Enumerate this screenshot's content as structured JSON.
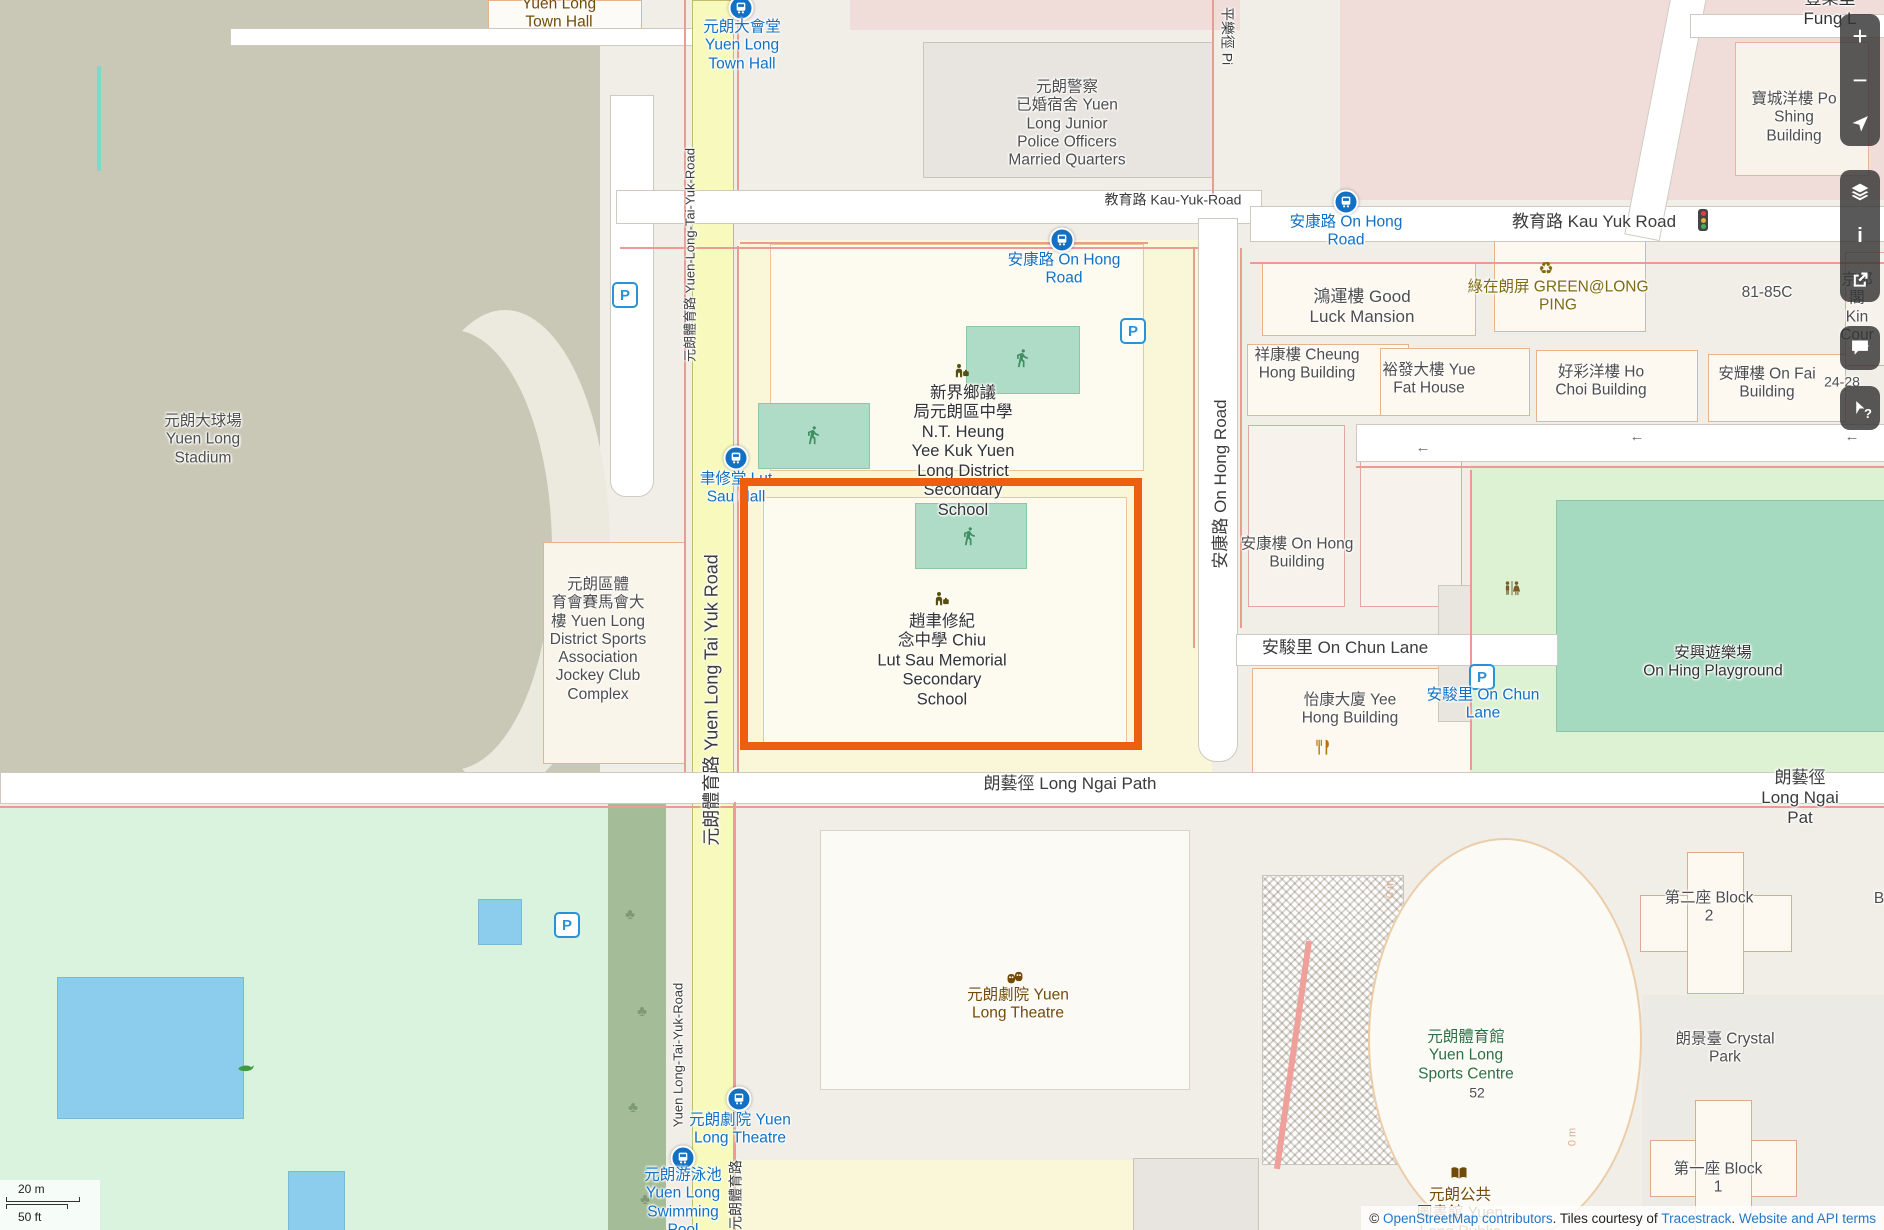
{
  "map_type": "openstreetmap-yuen-long",
  "colors": {
    "highlight": "#ed5f0e",
    "pitch": "#aedcc6",
    "water": "#8cccec",
    "road_yellow": "#f7fabc",
    "park_green": "#ddf2d3",
    "stadium_olive": "#c9c8b6",
    "transit_blue": "#1271c4",
    "amenity_brown": "#734a08"
  },
  "icons": {
    "tree": "♣",
    "recycle": "♻"
  },
  "roads": {
    "kau_yuk_left": "教育路 Kau-Yuk-Road",
    "kau_yuk_right": "教育路 Kau Yuk Road",
    "tai_yuk_small_top": "元朗體育路 Yuen-Long-Tai-Yuk-Road",
    "tai_yuk_main": "元朗體育路 Yuen Long Tai Yuk Road",
    "tai_yuk_small_bottom": "Yuen Long-Tai-Yuk-Road",
    "tai_yuk_cjk_bottom": "元朗體育路",
    "on_hong": "安康路 On Hong Road",
    "on_chun": "安駿里 On Chun Lane",
    "long_ngai_left": "朗藝徑 Long Ngai Path",
    "long_ngai_right": "朗藝徑 Long Ngai Pat",
    "ping_lok": "平樂徑 Pi",
    "fung_lok": "豐樂里 Fung L",
    "oneway_arrow": "←"
  },
  "stops": {
    "town_hall": "元朗大會堂\nYuen Long\nTown Hall",
    "on_hong_w": "安康路 On Hong\nRoad",
    "on_hong_e": "安康路 On Hong\nRoad",
    "lut_sau_hall": "聿修堂 Lut\nSau Hall",
    "theatre": "元朗劇院 Yuen\nLong Theatre",
    "swimming_pool": "元朗游泳池\nYuen Long\nSwimming\nPool",
    "on_chun_lane": "安駿里 On Chun\nLane"
  },
  "places": {
    "town_hall": "Yuen Long\nTown Hall",
    "police_quarters": "元朗警察\n已婚宿舍 Yuen\nLong Junior\nPolice Officers\nMarried Quarters",
    "stadium": "元朗大球場\nYuen Long\nStadium",
    "sports_assoc": "元朗區體\n育會賽馬會大\n樓 Yuen Long\nDistrict Sports\nAssociation\nJockey Club\nComplex",
    "nt_heung": "新界鄉議\n局元朗區中學\nN.T. Heung\nYee Kuk Yuen\nLong District\nSecondary\nSchool",
    "chiu_lut_sau": "趙聿修紀\n念中學 Chiu\nLut Sau Memorial\nSecondary\nSchool",
    "good_luck": "鴻運樓 Good\nLuck Mansion",
    "green_long_ping": "綠在朗屏 GREEN@LONG\nPING",
    "cheung_hong": "祥康樓 Cheung\nHong Building",
    "yue_fat": "裕發大樓 Yue\nFat House",
    "ho_choi": "好彩洋樓 Ho\nChoi Building",
    "on_fai": "安輝樓 On Fai\nBuilding",
    "addr_81": "81-85C",
    "kin_court": "京都閣 Kin\nCour",
    "addr_24": "24-28",
    "po_shing": "寶城洋樓 Po\nShing Building",
    "on_hong_bldg": "安康樓 On Hong\nBuilding",
    "yee_hong": "怡康大廈 Yee\nHong Building",
    "on_hing": "安興遊樂場\nOn Hing Playground",
    "theatre": "元朗劇院 Yuen\nLong Theatre",
    "sports_centre": "元朗體育館\nYuen Long\nSports Centre",
    "sports_centre_addr": "52",
    "library": "元朗公共\n圖書館 Yuen\nLong Public",
    "crystal_park": "朗景臺 Crystal\nPark",
    "block1": "第一座 Block\n1",
    "block2": "第二座 Block\n2",
    "block_edge": "B",
    "track_mark": "0 m"
  },
  "controls": {
    "zoom_in": "+",
    "zoom_out": "−",
    "key": "i",
    "query": "?"
  },
  "scalebar": {
    "metric": "20 m",
    "imperial": "50 ft"
  },
  "attribution": {
    "prefix": "© ",
    "link_osm": "OpenStreetMap contributors",
    "mid": ". Tiles courtesy of ",
    "link_tracestrack": "Tracestrack",
    "sep": ". ",
    "link_terms": "Website and API terms"
  }
}
